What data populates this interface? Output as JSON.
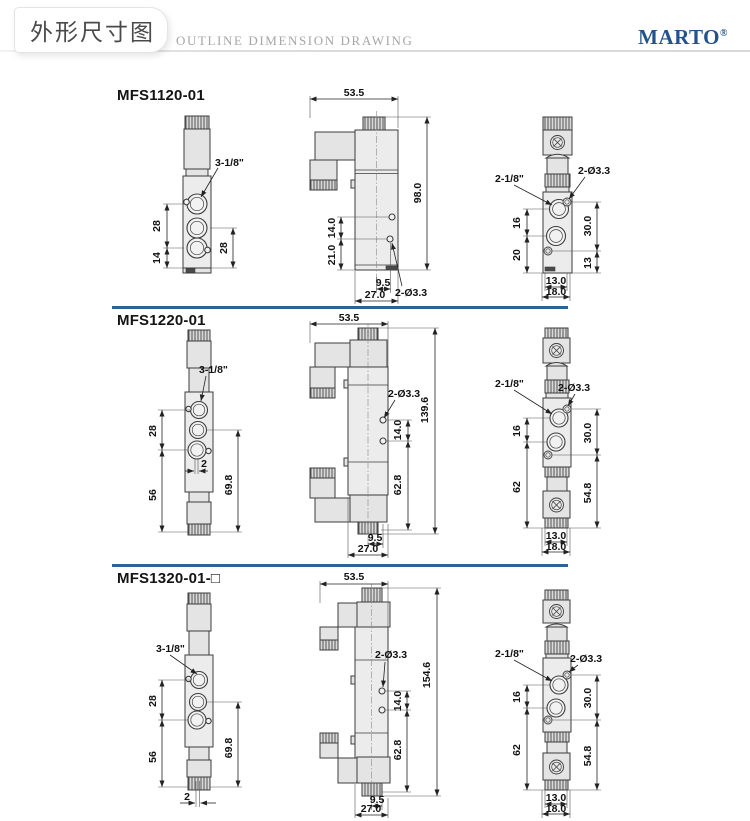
{
  "header": {
    "title_zh": "外形尺寸图",
    "title_en": "OUTLINE DIMENSION DRAWING",
    "brand": "MARTO",
    "brand_reg": "®"
  },
  "colors": {
    "divider_blue": "#2b6394",
    "brand_blue": "#23538c"
  },
  "sections": [
    {
      "model": "MFS1120-01",
      "front": {
        "port_callout": "3-1/8\"",
        "dim_ports": "28",
        "dim_bottom": "14",
        "dim_right": "28"
      },
      "side": {
        "dim_width": "53.5",
        "dim_height": "98.0",
        "dim_hole_gap": "14.0",
        "dim_hole_bottom": "21.0",
        "dim_foot_inner": "9.5",
        "dim_foot_outer": "27.0",
        "hole_callout": "2-Ø3.3"
      },
      "back": {
        "port_callout": "2-1/8\"",
        "hole_callout": "2-Ø3.3",
        "dim_left_upper": "16",
        "dim_left_lower": "20",
        "dim_right_upper": "30.0",
        "dim_right_lower": "13",
        "dim_bottom_inner": "13.0",
        "dim_bottom_outer": "18.0"
      }
    },
    {
      "model": "MFS1220-01",
      "front": {
        "port_callout": "3-1/8\"",
        "dim_ports": "28",
        "dim_bottom": "56",
        "dim_right": "69.8",
        "dim_offset": "2"
      },
      "side": {
        "dim_width": "53.5",
        "dim_height": "139.6",
        "dim_hole_gap": "14.0",
        "dim_hole_bottom": "62.8",
        "dim_foot_inner": "9.5",
        "dim_foot_outer": "27.0",
        "hole_callout": "2-Ø3.3"
      },
      "back": {
        "port_callout": "2-1/8\"",
        "hole_callout": "2-Ø3.3",
        "dim_left_upper": "16",
        "dim_left_lower": "62",
        "dim_right_upper": "30.0",
        "dim_right_lower": "54.8",
        "dim_bottom_inner": "13.0",
        "dim_bottom_outer": "18.0"
      }
    },
    {
      "model": "MFS1320-01-□",
      "front": {
        "port_callout": "3-1/8\"",
        "dim_ports": "28",
        "dim_bottom": "56",
        "dim_right": "69.8",
        "dim_offset": "2"
      },
      "side": {
        "dim_width": "53.5",
        "dim_height": "154.6",
        "dim_hole_gap": "14.0",
        "dim_hole_bottom": "62.8",
        "dim_foot_inner": "9.5",
        "dim_foot_outer": "27.0",
        "hole_callout": "2-Ø3.3"
      },
      "back": {
        "port_callout": "2-1/8\"",
        "hole_callout": "2-Ø3.3",
        "dim_left_upper": "16",
        "dim_left_lower": "62",
        "dim_right_upper": "30.0",
        "dim_right_lower": "54.8",
        "dim_bottom_inner": "13.0",
        "dim_bottom_outer": "18.0"
      }
    }
  ]
}
